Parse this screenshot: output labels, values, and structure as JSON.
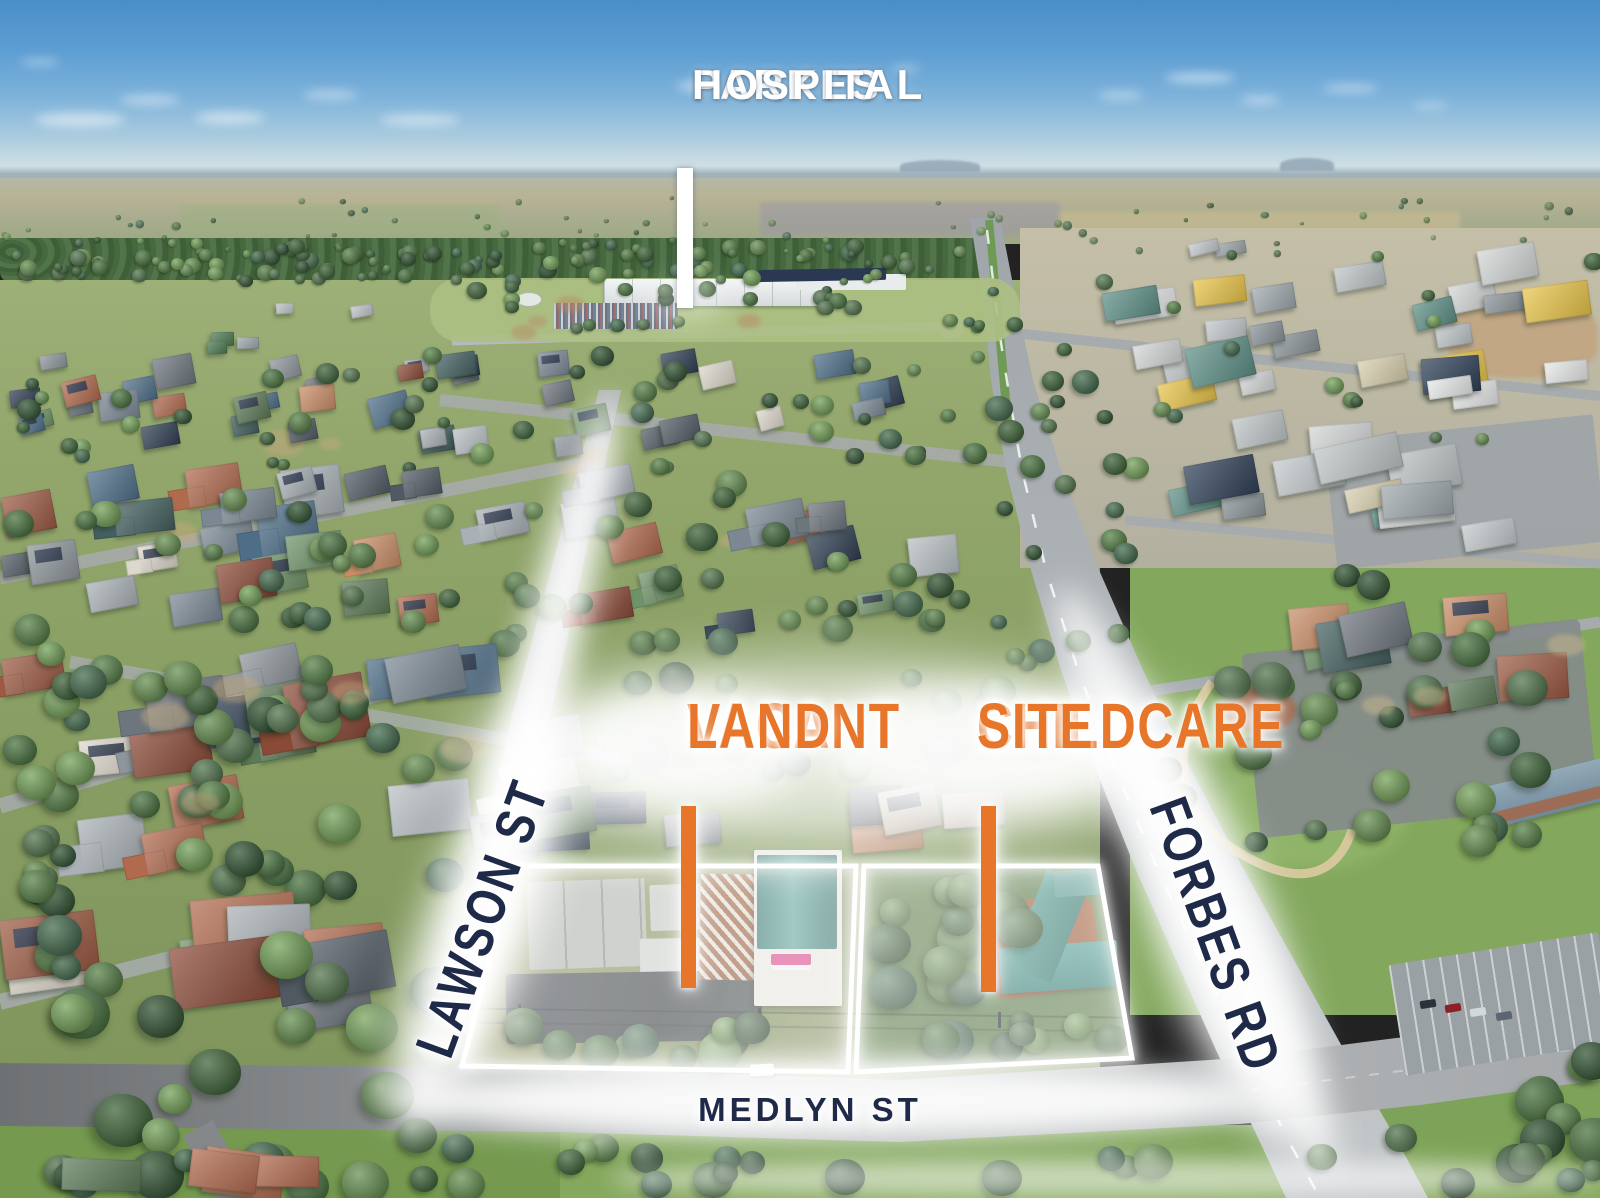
{
  "annotations": {
    "hospital": {
      "line1": "PARKES",
      "line2": "HOSPITAL"
    },
    "vacant": {
      "line1": "VACANT",
      "line2": "LAND"
    },
    "childcare": {
      "line1": "CHILDCARE",
      "line2": "SITE"
    },
    "streets": {
      "lawson": "LAWSON ST",
      "forbes": "FORBES RD",
      "medlyn": "MEDLYN ST"
    },
    "disclaimer": "IMAGE BOUNDARIES RELATING TO THIS PROPERTY ARE INDICATIVE ONLY"
  },
  "colors": {
    "orange": "#E7762B",
    "navy": "#1E2A47",
    "label_white": "#FFFFFF",
    "solar": "#1C2840"
  },
  "scene": {
    "seed": 12,
    "palettes": {
      "roof": [
        "#8e959b",
        "#6d757d",
        "#aab1b6",
        "#515a63",
        "#b9c0c4",
        "#9c5a42",
        "#b06a4e",
        "#8a4a38",
        "#c98d67",
        "#5d7a58",
        "#6f9368",
        "#43605f",
        "#4e6e88",
        "#7b8894",
        "#2f3e52",
        "#c7bca8",
        "#ddd8cc"
      ],
      "industrial": [
        "#e7e9e8",
        "#d3d7d6",
        "#bfc5c7",
        "#9fa8ad",
        "#5d8f86",
        "#4d7a52",
        "#2e4057",
        "#d8cfae",
        "#c4c9cc",
        "#8a9499",
        "#e8c44a"
      ],
      "tree": [
        "#2e512f",
        "#3a6135",
        "#46713c",
        "#547f44",
        "#648f4e",
        "#71a055",
        "#50734a",
        "#3f684a"
      ]
    },
    "clouds": [
      [
        80,
        120,
        90,
        14,
        0.5
      ],
      [
        150,
        100,
        60,
        10,
        0.45
      ],
      [
        230,
        118,
        70,
        12,
        0.5
      ],
      [
        330,
        95,
        55,
        10,
        0.4
      ],
      [
        420,
        120,
        80,
        12,
        0.45
      ],
      [
        40,
        62,
        40,
        8,
        0.35
      ],
      [
        690,
        86,
        26,
        8,
        0.5
      ],
      [
        1120,
        95,
        45,
        9,
        0.4
      ],
      [
        1200,
        78,
        70,
        10,
        0.5
      ],
      [
        1260,
        100,
        40,
        8,
        0.45
      ],
      [
        1350,
        88,
        55,
        9,
        0.4
      ],
      [
        1430,
        105,
        35,
        7,
        0.35
      ],
      [
        905,
        68,
        30,
        7,
        0.35
      ]
    ],
    "glows": [
      [
        830,
        758,
        740,
        190,
        30,
        0.72,
        0
      ],
      [
        687,
        747,
        250,
        118,
        18,
        0.85,
        0
      ],
      [
        977,
        747,
        330,
        118,
        18,
        0.85,
        0
      ],
      [
        527,
        737,
        700,
        60,
        14,
        0.9,
        -76
      ],
      [
        482,
        918,
        430,
        105,
        20,
        0.9,
        -70
      ],
      [
        1196,
        878,
        640,
        78,
        16,
        0.8,
        65
      ],
      [
        1216,
        935,
        430,
        112,
        20,
        0.85,
        70
      ],
      [
        822,
        1100,
        880,
        76,
        15,
        0.92,
        0
      ],
      [
        1108,
        1178,
        1000,
        38,
        10,
        0.55,
        0
      ],
      [
        688,
        302,
        80,
        36,
        14,
        0.4,
        0
      ]
    ],
    "layers": [
      {
        "t": "d",
        "r": [
          500,
          296,
          380,
          42
        ],
        "n": 4,
        "s": [
          6,
          12
        ],
        "c": "#b98a66",
        "op": 0.5
      },
      {
        "t": "t",
        "r": [
          0,
          196,
          1600,
          58
        ],
        "n": 70,
        "s": [
          2,
          5
        ],
        "op": 0.8
      },
      {
        "t": "t",
        "r": [
          0,
          238,
          980,
          44
        ],
        "n": 110,
        "s": [
          4,
          9
        ],
        "op": 1
      },
      {
        "t": "h",
        "r": [
          0,
          300,
          440,
          55
        ],
        "n": 5,
        "s": [
          14,
          26
        ],
        "a": [
          0.45,
          0.7
        ],
        "tilt": -5,
        "pal": "industrial"
      },
      {
        "t": "t",
        "r": [
          430,
          280,
          600,
          50
        ],
        "n": 26,
        "s": [
          5,
          10
        ],
        "op": 1
      },
      {
        "t": "h",
        "r": [
          1080,
          238,
          520,
          170
        ],
        "n": 28,
        "s": [
          30,
          68
        ],
        "a": [
          0.4,
          0.65
        ],
        "tilt": -9,
        "pal": "industrial"
      },
      {
        "t": "t",
        "r": [
          1040,
          250,
          560,
          190
        ],
        "n": 16,
        "s": [
          5,
          10
        ],
        "op": 1
      },
      {
        "t": "h",
        "r": [
          1150,
          400,
          450,
          150
        ],
        "n": 13,
        "s": [
          40,
          85
        ],
        "a": [
          0.4,
          0.6
        ],
        "tilt": -8,
        "pal": "industrial"
      },
      {
        "t": "d",
        "r": [
          60,
          430,
          900,
          120
        ],
        "n": 6,
        "s": [
          8,
          18
        ],
        "c": "#c4a87d",
        "op": 0.5
      },
      {
        "t": "h",
        "r": [
          0,
          340,
          930,
          120
        ],
        "n": 40,
        "s": [
          24,
          40
        ],
        "a": [
          0.55,
          0.85
        ],
        "tilt": -10,
        "pal": "roof",
        "solar": 0.2
      },
      {
        "t": "t",
        "r": [
          0,
          345,
          1000,
          125
        ],
        "n": 48,
        "s": [
          6,
          12
        ],
        "op": 1
      },
      {
        "t": "h",
        "r": [
          0,
          462,
          980,
          180
        ],
        "n": 36,
        "s": [
          36,
          60
        ],
        "a": [
          0.55,
          0.85
        ],
        "tilt": -10,
        "pal": "roof",
        "solar": 0.25,
        "wing": 0.3
      },
      {
        "t": "t",
        "r": [
          0,
          470,
          1040,
          180
        ],
        "n": 52,
        "s": [
          9,
          16
        ],
        "op": 1
      },
      {
        "t": "t",
        "r": [
          975,
          335,
          170,
          330
        ],
        "n": 24,
        "s": [
          7,
          14
        ],
        "op": 1
      },
      {
        "t": "h",
        "r": [
          1280,
          585,
          320,
          155
        ],
        "n": 9,
        "s": [
          45,
          70
        ],
        "a": [
          0.55,
          0.8
        ],
        "tilt": -8,
        "pal": "roof",
        "solar": 0.2
      },
      {
        "t": "t",
        "r": [
          1150,
          560,
          450,
          320
        ],
        "n": 30,
        "s": [
          10,
          22
        ],
        "op": 1
      },
      {
        "t": "d",
        "r": [
          1280,
          600,
          300,
          120
        ],
        "n": 3,
        "s": [
          10,
          20
        ],
        "c": "#c9b88c",
        "op": 0.5
      },
      {
        "t": "h",
        "r": [
          0,
          645,
          600,
          245
        ],
        "n": 20,
        "s": [
          54,
          84
        ],
        "a": [
          0.55,
          0.85
        ],
        "tilt": -9,
        "pal": "roof",
        "solar": 0.25,
        "wing": 0.3
      },
      {
        "t": "h",
        "r": [
          480,
          770,
          560,
          85
        ],
        "n": 8,
        "s": [
          52,
          72
        ],
        "a": [
          0.55,
          0.8
        ],
        "tilt": -6,
        "pal": "roof",
        "solar": 0.2
      },
      {
        "t": "t",
        "r": [
          0,
          655,
          500,
          245
        ],
        "n": 40,
        "s": [
          12,
          22
        ],
        "op": 1
      },
      {
        "t": "t",
        "r": [
          600,
          655,
          420,
          125
        ],
        "n": 18,
        "s": [
          10,
          18
        ],
        "op": 1
      },
      {
        "t": "d",
        "r": [
          80,
          640,
          500,
          200
        ],
        "n": 5,
        "s": [
          10,
          22
        ],
        "c": "#c4a87d",
        "op": 0.45
      },
      {
        "t": "h",
        "r": [
          0,
          892,
          432,
          150
        ],
        "n": 9,
        "s": [
          70,
          110
        ],
        "a": [
          0.55,
          0.8
        ],
        "tilt": -7,
        "pal": "roof",
        "solar": 0.3,
        "wing": 0.35
      },
      {
        "t": "t",
        "r": [
          0,
          900,
          450,
          290
        ],
        "n": 20,
        "s": [
          16,
          30
        ],
        "op": 1
      },
      {
        "t": "t",
        "r": [
          0,
          600,
          95,
          420
        ],
        "n": 14,
        "s": [
          12,
          24
        ],
        "op": 1
      },
      {
        "t": "t",
        "r": [
          492,
          1000,
          348,
          60
        ],
        "n": 11,
        "s": [
          13,
          22
        ],
        "op": 1
      },
      {
        "t": "t",
        "r": [
          858,
          872,
          168,
          188
        ],
        "n": 15,
        "s": [
          15,
          28
        ],
        "op": 1
      },
      {
        "t": "t",
        "r": [
          1008,
          998,
          116,
          62
        ],
        "n": 5,
        "s": [
          12,
          18
        ],
        "op": 1
      },
      {
        "t": "t",
        "r": [
          430,
          1128,
          830,
          62
        ],
        "n": 16,
        "s": [
          12,
          20
        ],
        "op": 1
      },
      {
        "t": "t",
        "r": [
          1478,
          1040,
          122,
          150
        ],
        "n": 8,
        "s": [
          14,
          26
        ],
        "op": 1
      },
      {
        "t": "t",
        "r": [
          1300,
          1086,
          300,
          100
        ],
        "n": 7,
        "s": [
          10,
          18
        ],
        "op": 1
      },
      {
        "t": "t",
        "r": [
          0,
          1130,
          430,
          60
        ],
        "n": 8,
        "s": [
          12,
          22
        ],
        "op": 1
      },
      {
        "t": "h",
        "r": [
          40,
          1150,
          360,
          44
        ],
        "n": 4,
        "s": [
          50,
          80
        ],
        "a": [
          0.4,
          0.6
        ],
        "tilt": 5,
        "pal": "roof"
      }
    ]
  }
}
